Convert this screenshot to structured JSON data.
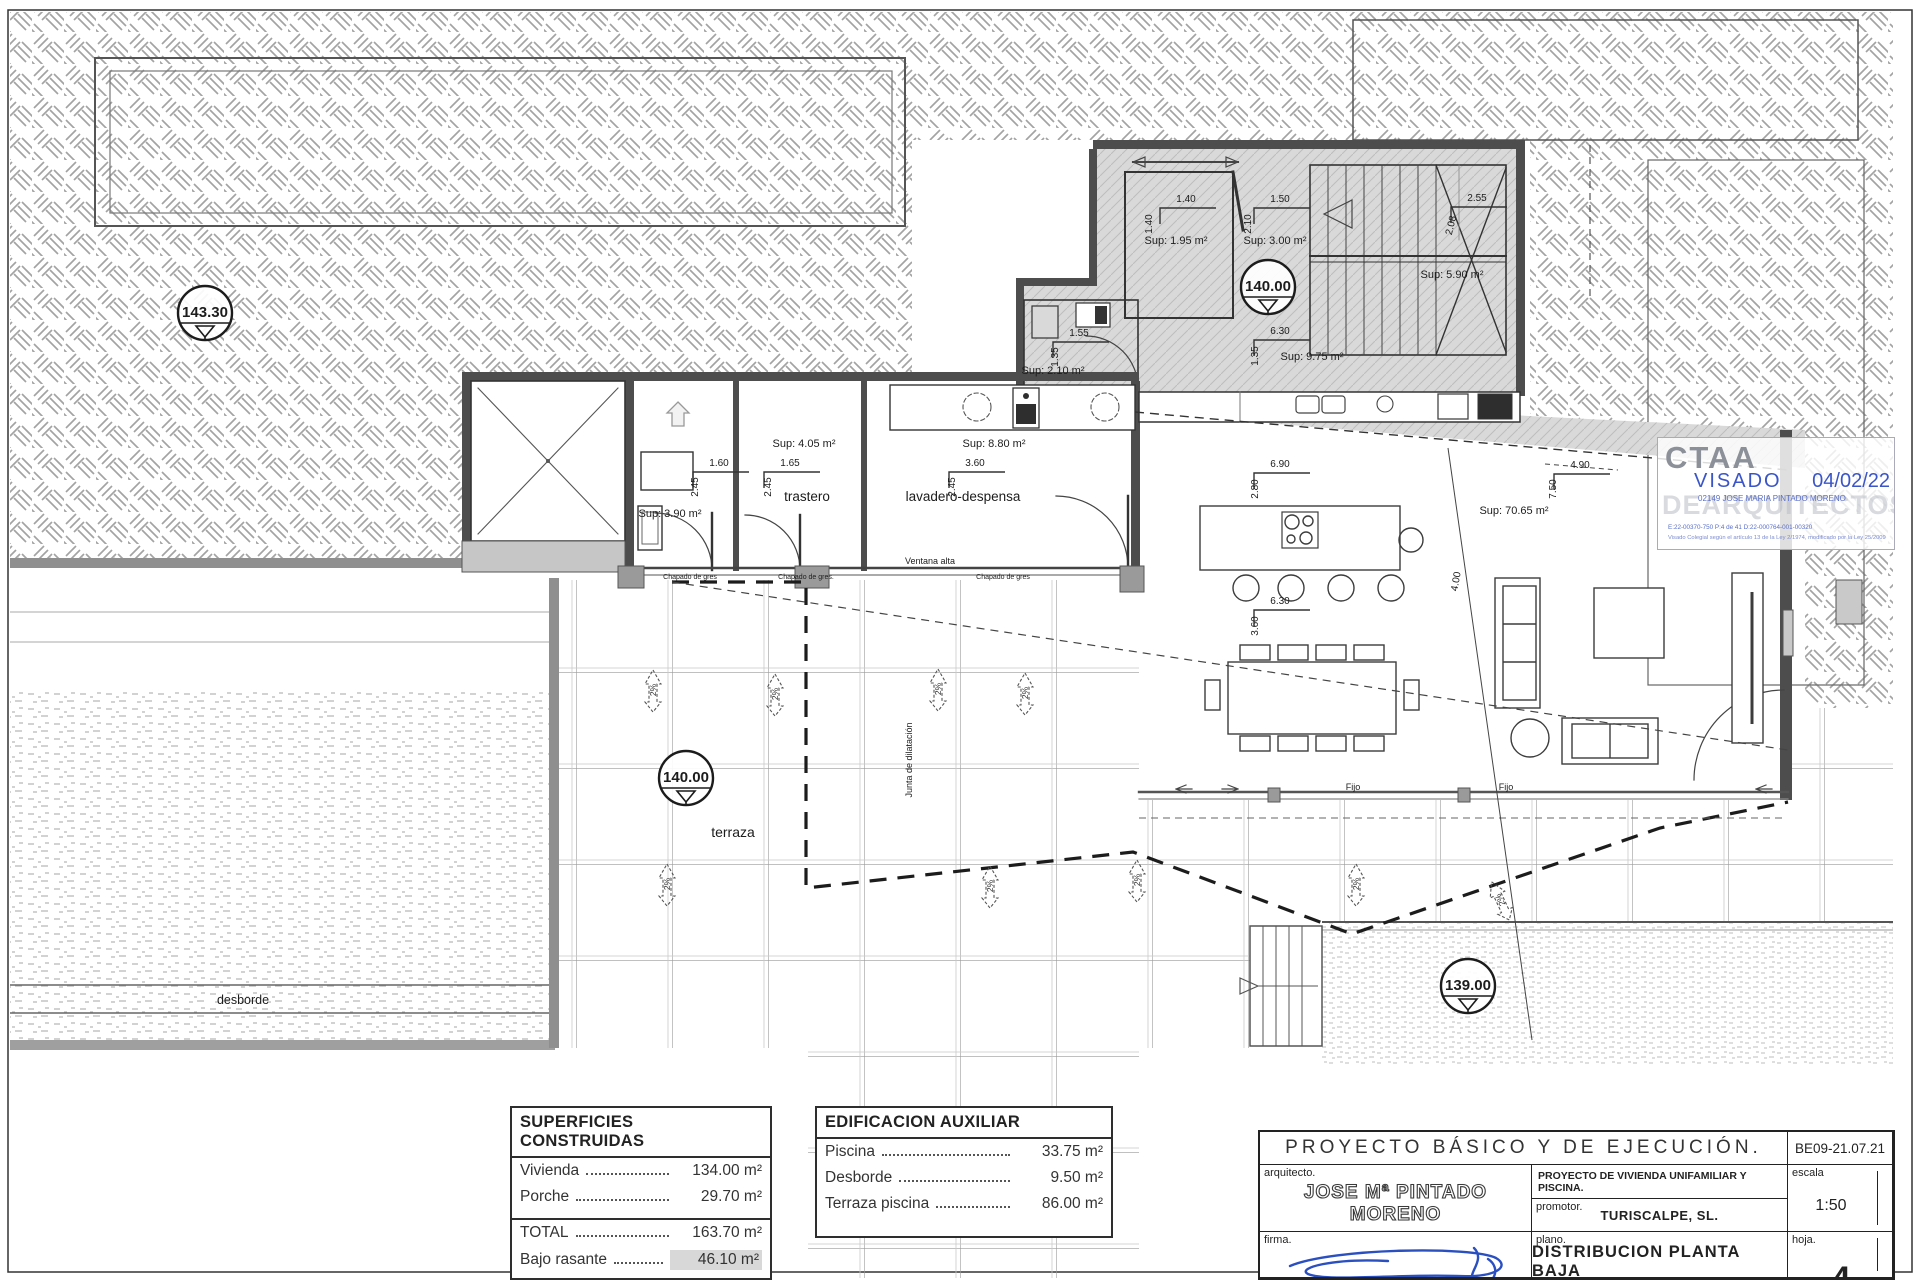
{
  "plan": {
    "labels": [
      {
        "t": "Sup: 1.95 m²",
        "x": 1176,
        "y": 244,
        "s": 11
      },
      {
        "t": "1.40",
        "x": 1186,
        "y": 202,
        "s": 10,
        "br": true
      },
      {
        "t": "1.40",
        "x": 1152,
        "y": 224,
        "s": 10,
        "r": -90
      },
      {
        "t": "Sup: 3.00 m²",
        "x": 1275,
        "y": 244,
        "s": 11
      },
      {
        "t": "1.50",
        "x": 1280,
        "y": 202,
        "s": 10,
        "br": true
      },
      {
        "t": "2.10",
        "x": 1251,
        "y": 224,
        "s": 10,
        "r": -90
      },
      {
        "t": "Sup: 5.90 m²",
        "x": 1452,
        "y": 278,
        "s": 11
      },
      {
        "t": "2.55",
        "x": 1477,
        "y": 201,
        "s": 10,
        "br": true
      },
      {
        "t": "2.08",
        "x": 1454,
        "y": 226,
        "s": 10,
        "r": -76
      },
      {
        "t": "6.30",
        "x": 1280,
        "y": 334,
        "s": 10,
        "br": true
      },
      {
        "t": "1.35",
        "x": 1258,
        "y": 356,
        "s": 10,
        "r": -90
      },
      {
        "t": "Sup: 9.75 m²",
        "x": 1312,
        "y": 360,
        "s": 11
      },
      {
        "t": "1.55",
        "x": 1079,
        "y": 336,
        "s": 10,
        "br": true
      },
      {
        "t": "1.35",
        "x": 1058,
        "y": 357,
        "s": 10,
        "r": -90
      },
      {
        "t": "Sup: 2.10 m²",
        "x": 1053,
        "y": 374,
        "s": 11
      },
      {
        "t": "Sup: 3.90 m²",
        "x": 670,
        "y": 517,
        "s": 11
      },
      {
        "t": "1.60",
        "x": 719,
        "y": 466,
        "s": 10,
        "br": true
      },
      {
        "t": "2.45",
        "x": 698,
        "y": 487,
        "s": 10,
        "r": -90
      },
      {
        "t": "Sup: 4.05 m²",
        "x": 804,
        "y": 447,
        "s": 11
      },
      {
        "t": "1.65",
        "x": 790,
        "y": 466,
        "s": 10,
        "br": true
      },
      {
        "t": "2.45",
        "x": 771,
        "y": 487,
        "s": 10,
        "r": -90
      },
      {
        "t": "trastero",
        "x": 807,
        "y": 501,
        "s": 13.5
      },
      {
        "t": "Sup: 8.80 m²",
        "x": 994,
        "y": 447,
        "s": 11
      },
      {
        "t": "3.60",
        "x": 975,
        "y": 466,
        "s": 10,
        "br": true
      },
      {
        "t": "2.45",
        "x": 955,
        "y": 487,
        "s": 10,
        "r": -90
      },
      {
        "t": "lavadero-despensa",
        "x": 963,
        "y": 501,
        "s": 13.5
      },
      {
        "t": "Ventana alta",
        "x": 930,
        "y": 564,
        "s": 9
      },
      {
        "t": "Chapado de gres",
        "x": 690,
        "y": 579,
        "s": 7
      },
      {
        "t": "Chapado de gres.",
        "x": 806,
        "y": 579,
        "s": 7
      },
      {
        "t": "Chapado de gres",
        "x": 1003,
        "y": 579,
        "s": 7
      },
      {
        "t": "6.90",
        "x": 1280,
        "y": 467,
        "s": 10,
        "br": true
      },
      {
        "t": "2.80",
        "x": 1258,
        "y": 489,
        "s": 10,
        "r": -90
      },
      {
        "t": "Sup: 70.65 m²",
        "x": 1514,
        "y": 514,
        "s": 11
      },
      {
        "t": "4.00",
        "x": 1459,
        "y": 582,
        "s": 10,
        "r": -80
      },
      {
        "t": "7.50",
        "x": 1556,
        "y": 489,
        "s": 10,
        "r": -90
      },
      {
        "t": "4.90",
        "x": 1580,
        "y": 468,
        "s": 10,
        "br": true
      },
      {
        "t": "6.30",
        "x": 1280,
        "y": 604,
        "s": 10,
        "br": true
      },
      {
        "t": "3.60",
        "x": 1258,
        "y": 626,
        "s": 10,
        "r": -90
      },
      {
        "t": "Fijo",
        "x": 1353,
        "y": 790,
        "s": 9
      },
      {
        "t": "Fijo",
        "x": 1506,
        "y": 790,
        "s": 9
      },
      {
        "t": "Junta de dilatación",
        "x": 912,
        "y": 760,
        "s": 9,
        "r": -90
      },
      {
        "t": "terraza",
        "x": 733,
        "y": 837,
        "s": 14
      },
      {
        "t": "desborde",
        "x": 243,
        "y": 1004,
        "s": 12.5
      }
    ],
    "elevation_markers": [
      {
        "v": "143.30",
        "x": 205,
        "y": 313
      },
      {
        "v": "140.00",
        "x": 1268,
        "y": 287
      },
      {
        "v": "140.00",
        "x": 686,
        "y": 778
      },
      {
        "v": "139.00",
        "x": 1468,
        "y": 986
      }
    ],
    "slope_markers": [
      {
        "t": "2%",
        "x": 653,
        "y": 690,
        "r": 0
      },
      {
        "t": "2%",
        "x": 775,
        "y": 694,
        "r": 0
      },
      {
        "t": "2%",
        "x": 938,
        "y": 689,
        "r": 0
      },
      {
        "t": "2%",
        "x": 1025,
        "y": 693,
        "r": 0
      },
      {
        "t": "2%",
        "x": 667,
        "y": 884,
        "r": 0
      },
      {
        "t": "2%",
        "x": 990,
        "y": 886,
        "r": 0
      },
      {
        "t": "2%",
        "x": 1137,
        "y": 880,
        "r": 0
      },
      {
        "t": "2%",
        "x": 1356,
        "y": 884,
        "r": 0
      },
      {
        "t": "2%",
        "x": 1500,
        "y": 900,
        "r": -25
      }
    ]
  },
  "stamp": {
    "org": "CTAA",
    "watermark": "DEARQUITECTOS",
    "visado": "VISADO",
    "date": "04/02/22",
    "collegiate": "02149 JOSE MARIA PINTADO MORENO",
    "refs": "E:22-00370-750      P:4 de 41      D:22-000764-001-00320",
    "legal": "Visado Colegial según el artículo 13 de la Ley 2/1974, modificado por la Ley 25/2009"
  },
  "tables": {
    "superficies": {
      "title": "SUPERFICIES CONSTRUIDAS",
      "rows": [
        {
          "label": "Vivienda",
          "value": "134.00 m²"
        },
        {
          "label": "Porche",
          "value": "29.70 m²"
        },
        {
          "sep": true
        },
        {
          "label": "TOTAL",
          "value": "163.70 m²"
        },
        {
          "label": "Bajo rasante",
          "value": "46.10 m²",
          "highlight": true
        }
      ]
    },
    "edificacion": {
      "title": "EDIFICACION AUXILIAR",
      "rows": [
        {
          "label": "Piscina",
          "value": "33.75 m²"
        },
        {
          "label": "Desborde",
          "value": "9.50 m²"
        },
        {
          "label": "Terraza piscina",
          "value": "86.00 m²"
        }
      ]
    }
  },
  "titleblock": {
    "title": "PROYECTO  BÁSICO  Y  DE  EJECUCIÓN.",
    "code": "BE09-21.07.21",
    "arquitecto_label": "arquitecto.",
    "arquitecto": "JOSE Mª PINTADO MORENO",
    "address1": "Pda.  CALETA  25-D;  03710  CALPE  (ALICANTE);  tel:  96 583 35 44.",
    "address2": "e.mail:  pintadoyrico@telefonica.net",
    "proyecto": "PROYECTO  DE  VIVIENDA  UNIFAMILIAR  Y  PISCINA.",
    "promotor_label": "promotor.",
    "promotor": "TURISCALPE,  SL.",
    "escala_label": "escala",
    "escala": "1:50",
    "firma_label": "firma.",
    "plano_label": "plano.",
    "plano": "DISTRIBUCION  PLANTA  BAJA",
    "hoja_label": "hoja.",
    "hoja": "4"
  },
  "colors": {
    "visado_blue": "#3a55c9",
    "wall_dark": "#4d4d4d",
    "covered_gray": "#d9d9d9",
    "highlight_gray": "#d8d8d8"
  }
}
